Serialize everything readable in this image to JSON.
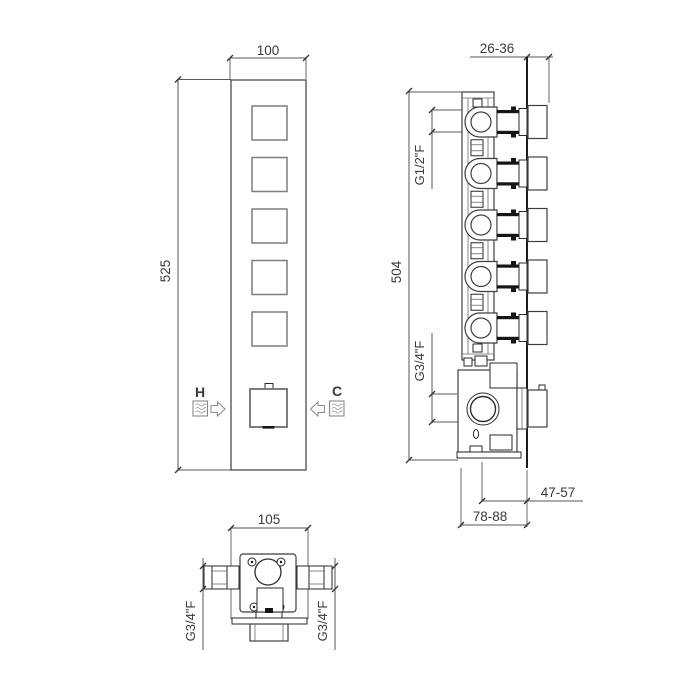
{
  "front_view": {
    "width": "100",
    "height": "525",
    "hot": "H",
    "cold": "C"
  },
  "side_view": {
    "wall_depth": "26-36",
    "height": "504",
    "upper_port": "G1/2\"F",
    "lower_port": "G3/4\"F",
    "center_to_wall": "47-57",
    "body_depth": "78-88"
  },
  "bottom_view": {
    "width": "105",
    "left_port": "G3/4\"F",
    "right_port": "G3/4\"F"
  }
}
